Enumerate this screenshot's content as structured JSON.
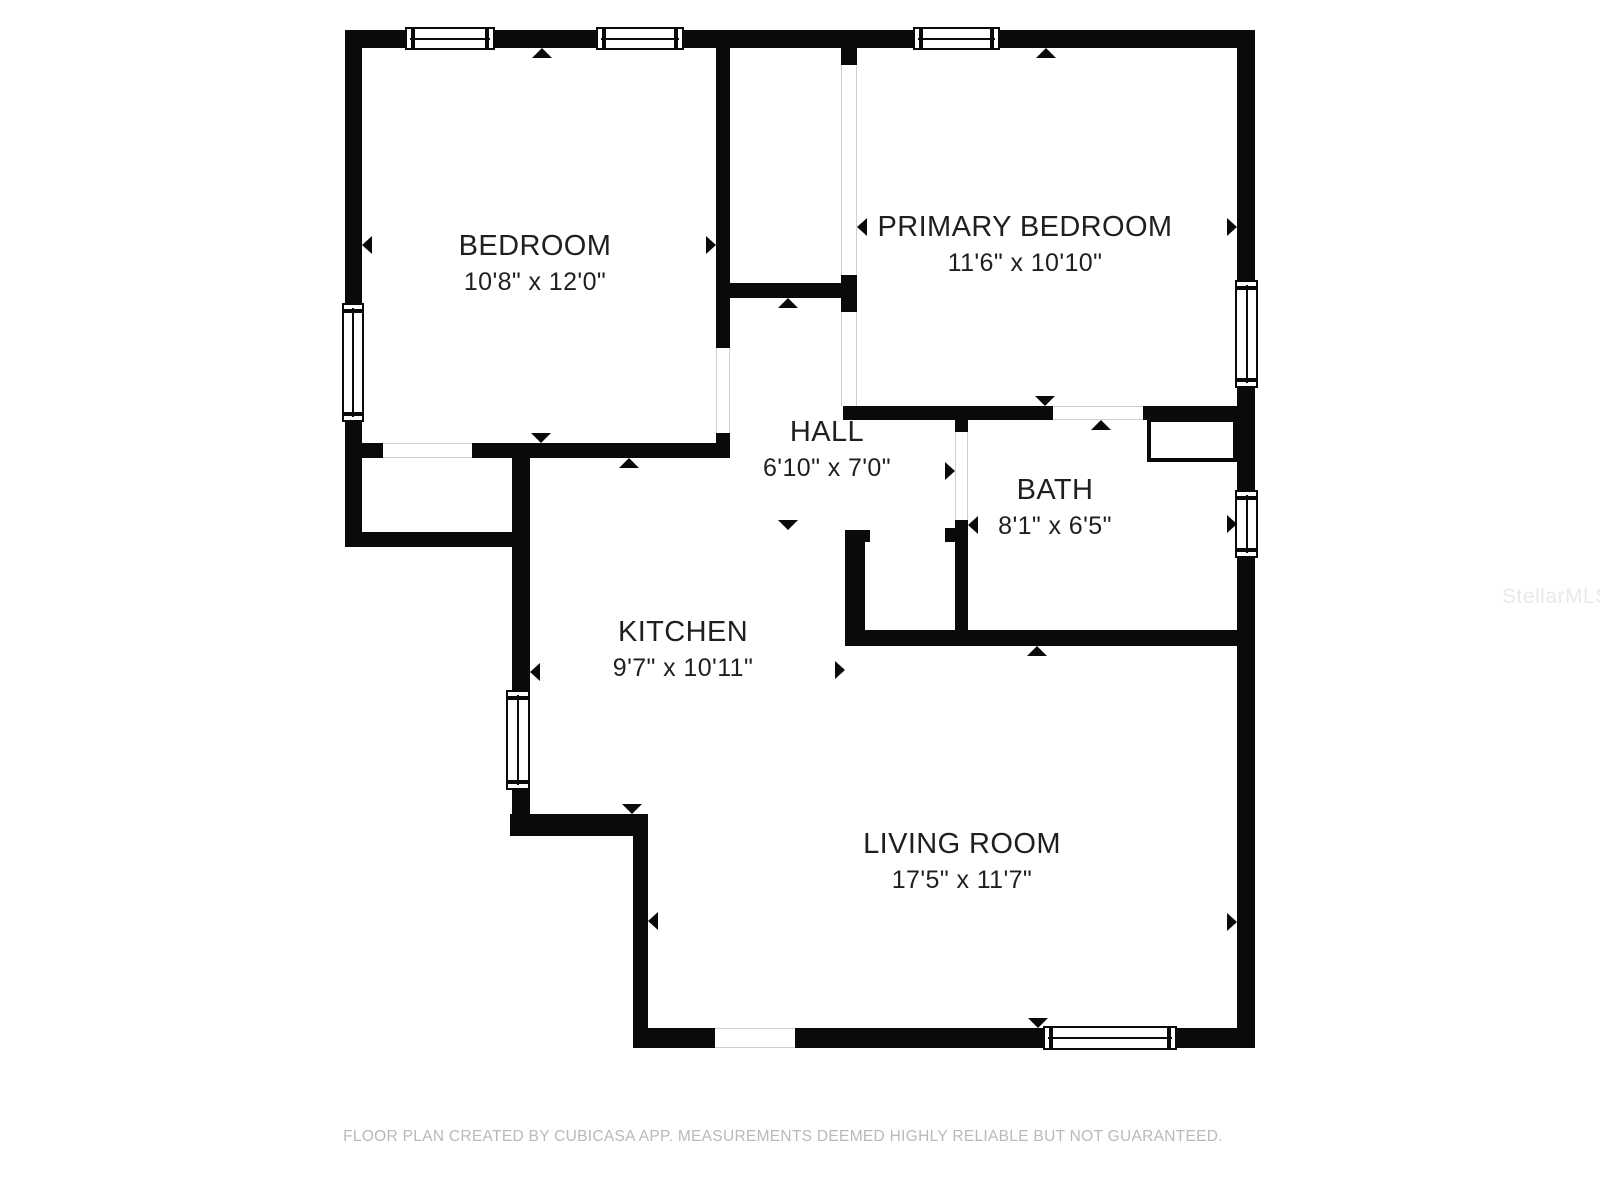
{
  "footer": {
    "text": "FLOOR PLAN CREATED BY CUBICASA APP. MEASUREMENTS DEEMED HIGHLY RELIABLE BUT NOT GUARANTEED."
  },
  "watermark": {
    "text": "StellarMLS"
  },
  "colors": {
    "wall": "#0a0a0a",
    "label_text": "#1f1f1f",
    "footer_text": "#b9b9b9",
    "watermark_text": "#e9e9e9",
    "opening_line": "#cfcfcf",
    "background": "#ffffff"
  },
  "rooms": [
    {
      "id": "bedroom",
      "name": "BEDROOM",
      "dims": "10'8\" x 12'0\"",
      "cx": 535,
      "cy": 247
    },
    {
      "id": "primary-bedroom",
      "name": "PRIMARY BEDROOM",
      "dims": "11'6\" x 10'10\"",
      "cx": 1025,
      "cy": 228
    },
    {
      "id": "hall",
      "name": "HALL",
      "dims": "6'10\" x 7'0\"",
      "cx": 827,
      "cy": 433
    },
    {
      "id": "bath",
      "name": "BATH",
      "dims": "8'1\" x 6'5\"",
      "cx": 1055,
      "cy": 491
    },
    {
      "id": "kitchen",
      "name": "KITCHEN",
      "dims": "9'7\" x 10'11\"",
      "cx": 683,
      "cy": 633
    },
    {
      "id": "living-room",
      "name": "LIVING ROOM",
      "dims": "17'5\" x 11'7\"",
      "cx": 962,
      "cy": 845
    }
  ],
  "plan": {
    "walls": [
      [
        345,
        30,
        910,
        18
      ],
      [
        345,
        30,
        17,
        517
      ],
      [
        345,
        532,
        185,
        15
      ],
      [
        512,
        443,
        18,
        371
      ],
      [
        510,
        814,
        138,
        22
      ],
      [
        633,
        836,
        15,
        212
      ],
      [
        633,
        1028,
        622,
        20
      ],
      [
        1237,
        30,
        18,
        1018
      ],
      [
        716,
        48,
        14,
        410
      ],
      [
        362,
        443,
        368,
        15
      ],
      [
        730,
        283,
        113,
        15
      ],
      [
        841,
        48,
        16,
        358
      ],
      [
        843,
        406,
        394,
        14
      ],
      [
        843,
        396,
        14,
        10
      ],
      [
        955,
        420,
        13,
        226
      ],
      [
        945,
        528,
        10,
        14
      ],
      [
        845,
        530,
        20,
        116
      ],
      [
        865,
        530,
        5,
        12
      ],
      [
        845,
        630,
        392,
        16
      ]
    ],
    "windows": [
      {
        "x": 405,
        "y": 27,
        "w": 90,
        "h": 23,
        "o": "h"
      },
      {
        "x": 596,
        "y": 27,
        "w": 88,
        "h": 23,
        "o": "h"
      },
      {
        "x": 913,
        "y": 27,
        "w": 87,
        "h": 23,
        "o": "h"
      },
      {
        "x": 342,
        "y": 303,
        "w": 22,
        "h": 119,
        "o": "v"
      },
      {
        "x": 506,
        "y": 690,
        "w": 24,
        "h": 100,
        "o": "v"
      },
      {
        "x": 1235,
        "y": 280,
        "w": 23,
        "h": 108,
        "o": "v"
      },
      {
        "x": 1235,
        "y": 490,
        "w": 23,
        "h": 68,
        "o": "v"
      },
      {
        "x": 1043,
        "y": 1026,
        "w": 134,
        "h": 24,
        "o": "h"
      }
    ],
    "openings": [
      {
        "x": 383,
        "y": 443,
        "w": 89,
        "h": 15,
        "o": "h"
      },
      {
        "x": 716,
        "y": 348,
        "w": 14,
        "h": 85,
        "o": "v"
      },
      {
        "x": 841,
        "y": 65,
        "w": 16,
        "h": 210,
        "o": "v"
      },
      {
        "x": 841,
        "y": 312,
        "w": 16,
        "h": 94,
        "o": "v"
      },
      {
        "x": 1053,
        "y": 406,
        "w": 90,
        "h": 14,
        "o": "h"
      },
      {
        "x": 955,
        "y": 432,
        "w": 13,
        "h": 88,
        "o": "v"
      },
      {
        "x": 715,
        "y": 1028,
        "w": 80,
        "h": 20,
        "o": "h"
      }
    ],
    "fixtures": [
      {
        "x": 1147,
        "y": 418,
        "w": 90,
        "h": 44
      }
    ],
    "arrows": [
      {
        "x": 542,
        "y": 48,
        "dir": "up"
      },
      {
        "x": 1046,
        "y": 48,
        "dir": "up"
      },
      {
        "x": 362,
        "y": 245,
        "dir": "left"
      },
      {
        "x": 716,
        "y": 245,
        "dir": "right"
      },
      {
        "x": 541,
        "y": 443,
        "dir": "down"
      },
      {
        "x": 629,
        "y": 458,
        "dir": "up"
      },
      {
        "x": 788,
        "y": 298,
        "dir": "up"
      },
      {
        "x": 857,
        "y": 227,
        "dir": "left"
      },
      {
        "x": 1237,
        "y": 227,
        "dir": "right"
      },
      {
        "x": 1045,
        "y": 406,
        "dir": "down"
      },
      {
        "x": 1101,
        "y": 420,
        "dir": "up"
      },
      {
        "x": 955,
        "y": 471,
        "dir": "right"
      },
      {
        "x": 968,
        "y": 525,
        "dir": "left"
      },
      {
        "x": 788,
        "y": 530,
        "dir": "down"
      },
      {
        "x": 530,
        "y": 672,
        "dir": "left"
      },
      {
        "x": 845,
        "y": 670,
        "dir": "right"
      },
      {
        "x": 632,
        "y": 814,
        "dir": "down"
      },
      {
        "x": 648,
        "y": 921,
        "dir": "left"
      },
      {
        "x": 1237,
        "y": 922,
        "dir": "right"
      },
      {
        "x": 1038,
        "y": 1028,
        "dir": "down"
      },
      {
        "x": 1037,
        "y": 646,
        "dir": "up"
      },
      {
        "x": 1237,
        "y": 524,
        "dir": "right"
      }
    ]
  }
}
